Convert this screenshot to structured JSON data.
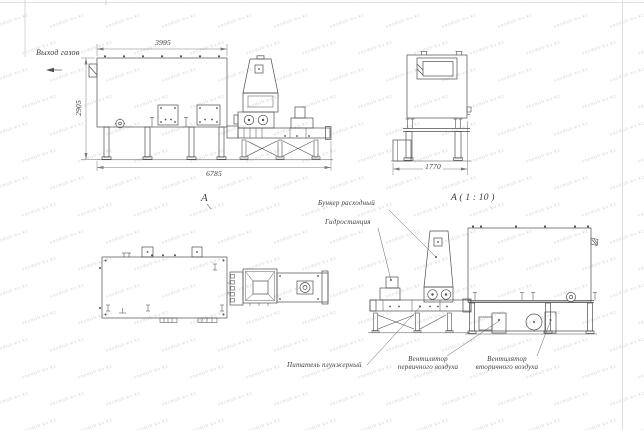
{
  "sheet": {
    "watermark_text": "vozduh-kv.kz",
    "colors": {
      "line": "#4f4f4f",
      "thin_line": "#6f6f6f",
      "text": "#3c3c3c"
    }
  },
  "views": {
    "side": {
      "gas_outlet_label": "Выход газов",
      "dimensions": {
        "body_length": "3995",
        "height": "2905",
        "total_length": "6785"
      }
    },
    "end": {
      "dimensions": {
        "width": "1770"
      }
    },
    "plan": {
      "section_label": "A"
    },
    "detail": {
      "title": "A ( 1 : 10 )",
      "callouts": {
        "hopper": "Бункер расходный",
        "hydro_station": "Гидростанция",
        "plunger_feeder": "Питатель плунжерный",
        "primary_fan_line1": "Вентилятор",
        "primary_fan_line2": "первичного воздуха",
        "secondary_fan_line1": "Вентилятор",
        "secondary_fan_line2": "вторичного воздуха"
      }
    }
  }
}
